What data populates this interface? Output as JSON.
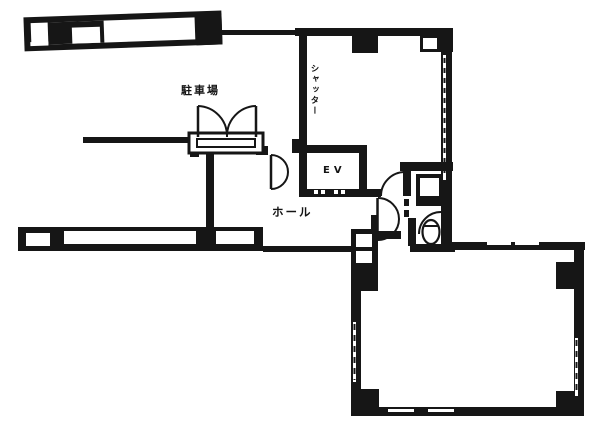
{
  "plan": {
    "type": "floor-plan",
    "labels": {
      "parking": "駐車場",
      "shutter": "シャッター",
      "elevator": "EV",
      "hall": "ホール"
    },
    "colors": {
      "line": "#161616",
      "background": "#ffffff"
    }
  }
}
